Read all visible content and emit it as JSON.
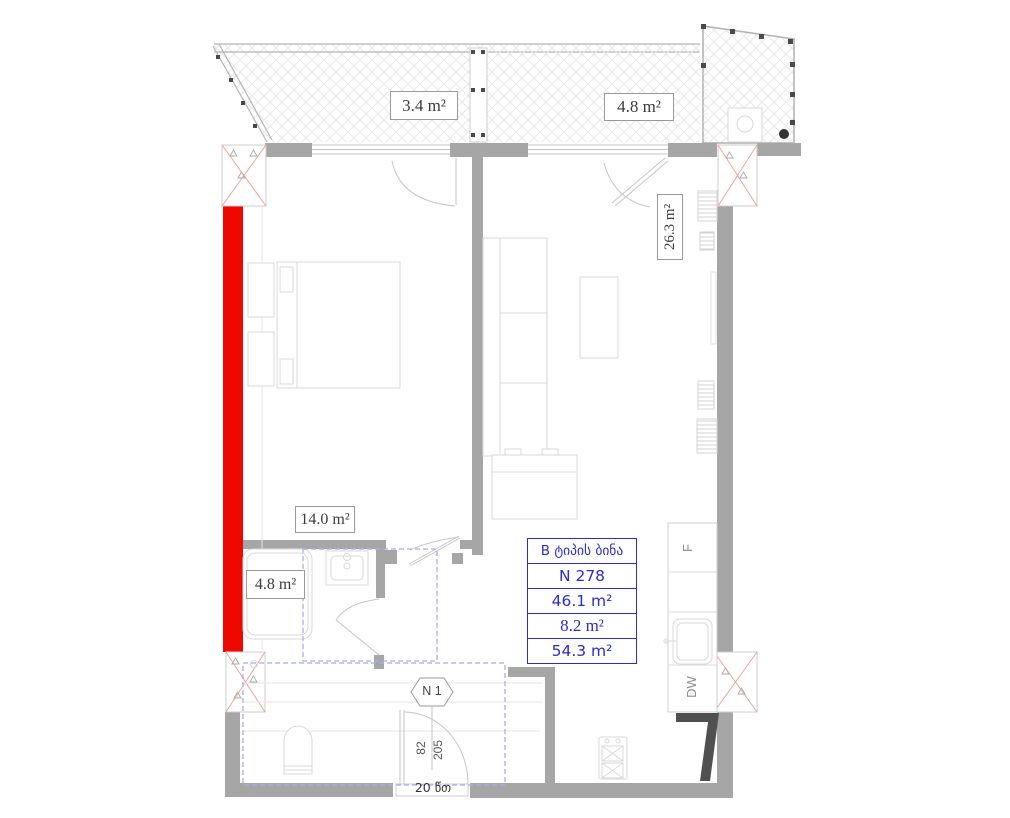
{
  "title": "Apartment floor plan",
  "labels": {
    "balcony_left_area": "3.4 m²",
    "balcony_right_area": "4.8 m²",
    "living_area": "26.3 m²",
    "bedroom_area": "14.0 m²",
    "bathroom_area": "4.8 m²"
  },
  "info_box": {
    "type_label": "B ტიპის ბინა",
    "apartment_number": "N 278",
    "net_area": "46.1 m²",
    "balcony_area": "8.2 m²",
    "total_area": "54.3 m²"
  },
  "entry": {
    "door_tag": "N 1",
    "door_width": "82",
    "door_height": "205",
    "note": "20 წთ"
  },
  "appliances": {
    "fridge": "F",
    "dishwasher": "DW"
  },
  "colors": {
    "wall": "#a6a6a6",
    "highlight_red": "#ee0800",
    "column_x_red": "#f0a49b",
    "info_blue": "#2b2bd2",
    "dashed_blue": "#a8aee6",
    "furniture": "#d9d9d9"
  }
}
